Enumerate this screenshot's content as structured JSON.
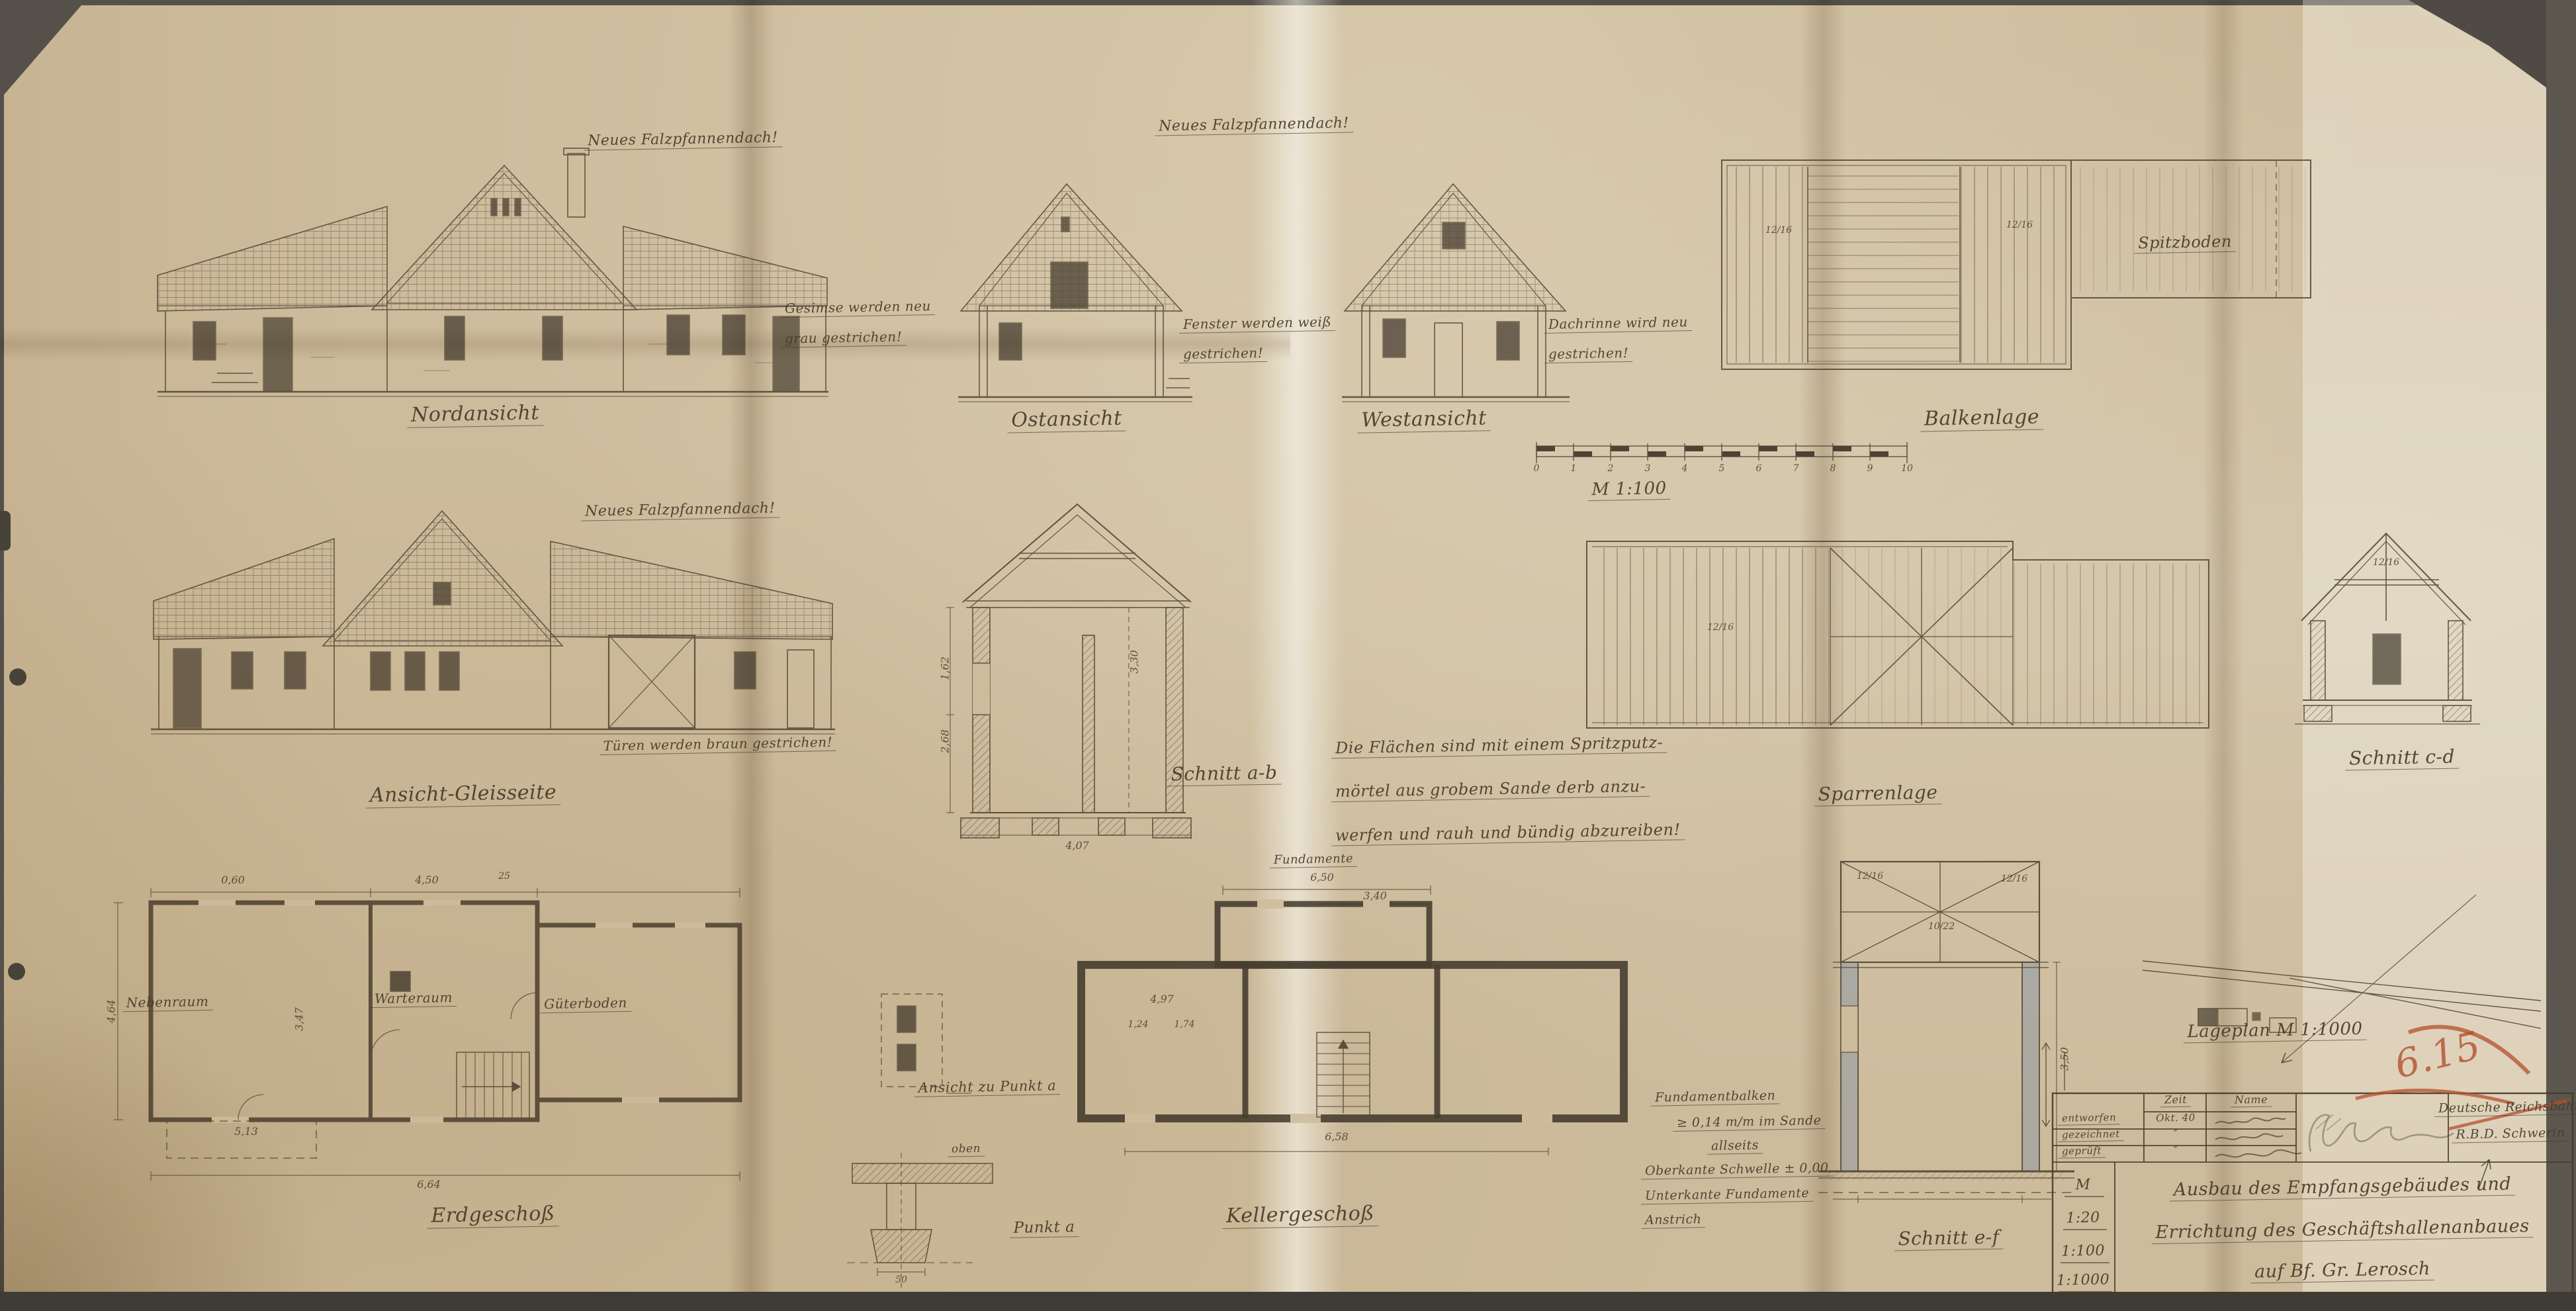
{
  "sheet": {
    "roof_note": "Neues Falzpfannendach!",
    "scale_label": "M 1:100",
    "scale_ticks": [
      "0",
      "1",
      "2",
      "3",
      "4",
      "5",
      "6",
      "7",
      "8",
      "9",
      "10"
    ]
  },
  "views": {
    "nordansicht": "Nordansicht",
    "ostansicht": "Ostansicht",
    "westansicht": "Westansicht",
    "balkenlage": "Balkenlage",
    "spitzboden": "Spitzboden",
    "gleisseite": "Ansicht-Gleisseite",
    "schnitt_ab": "Schnitt a-b",
    "sparrenlage": "Sparrenlage",
    "schnitt_cd": "Schnitt c-d",
    "erdgeschoss": "Erdgeschoß",
    "kellergeschoss": "Kellergeschoß",
    "fundamente": "Fundamente",
    "schnitt_ef": "Schnitt e-f",
    "punkt_a": "Punkt a",
    "ansicht_punkt_a": "Ansicht zu Punkt a",
    "oben": "oben",
    "lageplan": "Lageplan M 1:1000"
  },
  "rooms": {
    "left": "Nebenraum",
    "mid": "Warteraum",
    "right": "Güterboden"
  },
  "notes": {
    "north": [
      "Gesimse werden neu",
      "grau gestrichen!"
    ],
    "east": [
      "Fenster werden weiß",
      "gestrichen!"
    ],
    "west": [
      "Dachrinne wird neu",
      "gestrichen!"
    ],
    "gleis": "Türen werden braun gestrichen!",
    "plaster": [
      "Die Flächen sind mit einem Spritzputz-",
      "mörtel aus grobem Sande derb anzu-",
      "werfen und rauh und bündig abzureiben!"
    ],
    "foundation": [
      "Fundamentbalken",
      "≥ 0,14 m/m im Sande",
      "allseits",
      "Oberkante Schwelle ± 0,00",
      "Unterkante Fundamente",
      "Anstrich"
    ]
  },
  "dims": {
    "d060": "0,60",
    "d450": "4,50",
    "d25": "25",
    "d513": "5,13",
    "d464": "4,64",
    "d347": "3,47",
    "d664": "6,64",
    "d650": "6,50",
    "d340": "3,40",
    "d497": "4,97",
    "d124": "1,24",
    "d174": "1,74",
    "d658": "6,58",
    "d162": "1,62",
    "d268": "2,68",
    "d407": "4,07",
    "d330": "3,30",
    "d50": "50",
    "d350": "3,50"
  },
  "beams": {
    "b1216": "12/16",
    "b1022": "10/22"
  },
  "title_block": {
    "header_zeit": "Zeit",
    "header_name": "Name",
    "row1_label": "entworfen",
    "row1_zeit": "Okt. 40",
    "row2_label": "gezeichnet",
    "row2_zeit": "″",
    "row3_label": "geprüft",
    "row3_zeit": "″",
    "stamp_line1": "Deutsche Reichsbahn",
    "stamp_line2": "R.B.D. Schwerin",
    "scale_m": "M",
    "scale_20": "1:20",
    "scale_100": "1:100",
    "scale_1000": "1:1000",
    "title_line1": "Ausbau des Empfangsgebäudes und",
    "title_line2": "Errichtung des Geschäftshallenanbaues",
    "title_line3": "auf Bf. Gr. Lerosch",
    "red_mark": "6.15"
  }
}
